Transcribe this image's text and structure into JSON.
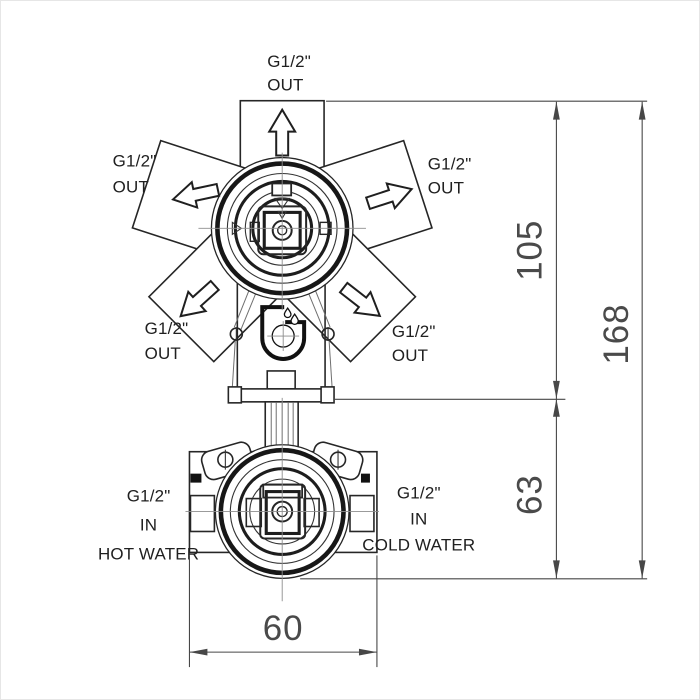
{
  "drawing": {
    "ports": {
      "top": {
        "thread": "G1/2\"",
        "flow": "OUT"
      },
      "upper_left": {
        "thread": "G1/2\"",
        "flow": "OUT"
      },
      "upper_right": {
        "thread": "G1/2\"",
        "flow": "OUT"
      },
      "lower_left": {
        "thread": "G1/2\"",
        "flow": "OUT"
      },
      "lower_right": {
        "thread": "G1/2\"",
        "flow": "OUT"
      }
    },
    "inlets": {
      "hot": {
        "thread": "G1/2\"",
        "flow": "IN",
        "medium": "HOT WATER"
      },
      "cold": {
        "thread": "G1/2\"",
        "flow": "IN",
        "medium": "COLD WATER"
      }
    },
    "dimensions": {
      "upper_height": "105",
      "lower_height": "63",
      "total_height": "168",
      "body_width": "60"
    },
    "icons": {
      "outlet_arrow": "hollow-directional-arrow",
      "brand_mark": "droplets-dial-logo"
    }
  },
  "colors": {
    "background": "#ffffff",
    "border": "#e6e6e6",
    "line": "#262626",
    "dim": "#474747",
    "dim_text": "#4a4a4a"
  }
}
